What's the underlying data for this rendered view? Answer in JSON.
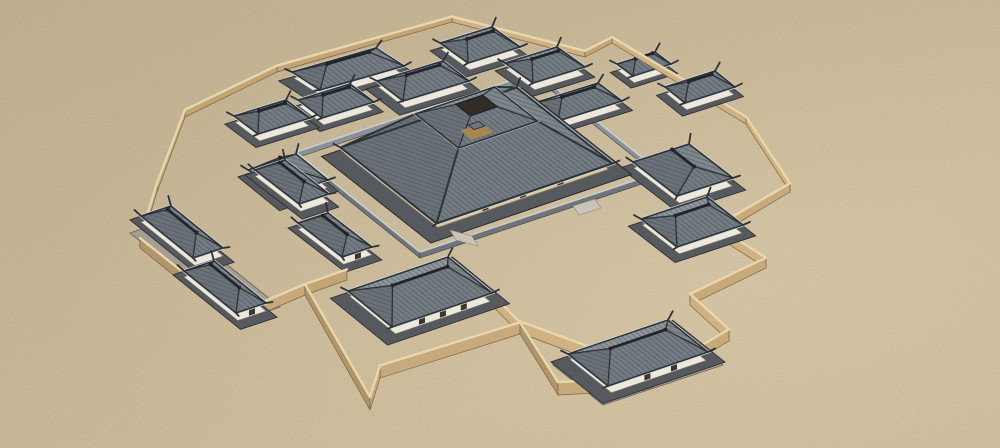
{
  "scene": {
    "viewBox": "0 0 1000 448",
    "width": 1000,
    "height": 448,
    "description": "3d-model-render-of-walled-temple-complex",
    "background": "#c9b692"
  },
  "palette": {
    "ground": "#c9b692",
    "wallLit": "#cfb183",
    "wallMid": "#c3a475",
    "wallDark": "#b2946b",
    "wallBack": "#c7a97c",
    "wallTop": "#e8d7ac",
    "wallEdge": "#7d6646",
    "roofS": "#747c83",
    "roofN": "#8e969c",
    "roofW": "#6a7178",
    "roofE": "#7f878d",
    "roofStripe": "#42484e",
    "roofEdge": "#2d3236",
    "ridge": "#21252a",
    "fascia": "#d5d8db",
    "platform": "#56595d",
    "platEdge": "#26292c",
    "white": "#ece8dc",
    "whiteEdge": "#6f6c64",
    "door": "#3a362d",
    "tanBand": "#d8c9a4",
    "step": "#cac4b8",
    "court": "#a59f93",
    "courtEdge": "#6e6960",
    "innerWallLit": "#8a9095",
    "innerWallDark": "#70757a",
    "innerWallTop": "#c9ced2",
    "openDark": "#322e27",
    "openFloor": "#a8874f",
    "openRoof": "#70757b"
  },
  "outerWall": {
    "heightBase": 5,
    "heightSlope": 0.02,
    "heightMax": 13,
    "points": [
      [
        157,
        192
      ],
      [
        185,
        117
      ],
      [
        277,
        72
      ],
      [
        452,
        22
      ],
      [
        585,
        57
      ],
      [
        612,
        43
      ],
      [
        746,
        124
      ],
      [
        790,
        192
      ],
      [
        716,
        236
      ],
      [
        766,
        268
      ],
      [
        690,
        305
      ],
      [
        729,
        341
      ],
      [
        648,
        390
      ],
      [
        558,
        395
      ],
      [
        520,
        334
      ],
      [
        380,
        378
      ],
      [
        370,
        410
      ],
      [
        305,
        295
      ],
      [
        235,
        325
      ],
      [
        140,
        248
      ]
    ],
    "stubs": [
      [
        [
          477,
          290
        ],
        [
          520,
          334
        ]
      ],
      [
        [
          520,
          333
        ],
        [
          603,
          364
        ]
      ],
      [
        [
          215,
          292
        ],
        [
          240,
          328
        ]
      ],
      [
        [
          305,
          295
        ],
        [
          347,
          280
        ]
      ]
    ]
  },
  "innerWall": {
    "w": [
      296,
      158
    ],
    "n": [
      536,
      78
    ],
    "e": [
      660,
      178
    ],
    "s": [
      420,
      258
    ],
    "height": 6
  },
  "courts": [
    {
      "name": "west-court-platform",
      "c": [
        205,
        262
      ],
      "u": [
        20,
        -7
      ],
      "v": [
        55,
        44
      ],
      "z": 253
    },
    {
      "name": "southeast-court-platform",
      "c": [
        638,
        357
      ],
      "u": [
        60,
        -20
      ],
      "v": [
        25,
        20
      ],
      "z": 317
    }
  ],
  "centralHall": {
    "name": "central-hall",
    "c": [
      476.5,
      155.5
    ],
    "u": [
      88,
      -30
    ],
    "v": [
      48,
      38
    ],
    "clerK": 0.45,
    "clerRaise": 38,
    "rimK": 0.15,
    "rimRaise": 50,
    "openK": 0.12,
    "openRaise": 24,
    "doors": 3,
    "z": 246,
    "steps": [
      [
        [
          450,
          230
        ],
        [
          472,
          236
        ],
        [
          478,
          246
        ],
        [
          456,
          240
        ]
      ],
      [
        [
          573,
          206
        ],
        [
          595,
          199
        ],
        [
          601,
          208
        ],
        [
          579,
          215
        ]
      ]
    ]
  },
  "buildings": [
    {
      "name": "north-court-west-hall",
      "c": [
        348,
        72
      ],
      "u": [
        42,
        -12
      ],
      "v": [
        14,
        9
      ],
      "axis": "u",
      "k": 0.5,
      "rh": 11
    },
    {
      "name": "north-court-east-hall-a",
      "c": [
        480,
        48
      ],
      "u": [
        26,
        -8
      ],
      "v": [
        14,
        10
      ],
      "axis": "u",
      "k": 0.5,
      "rh": 10
    },
    {
      "name": "north-court-east-hall-b",
      "c": [
        545,
        68
      ],
      "u": [
        26,
        -8
      ],
      "v": [
        14,
        10
      ],
      "axis": "u",
      "k": 0.5,
      "rh": 10
    },
    {
      "name": "northeast-pavilion-a",
      "c": [
        644,
        67
      ],
      "u": [
        19,
        -6
      ],
      "v": [
        8,
        6
      ],
      "axis": "u",
      "k": 0.45,
      "rh": 8
    },
    {
      "name": "northeast-pavilion-b",
      "c": [
        700,
        90
      ],
      "u": [
        25,
        -8
      ],
      "v": [
        10,
        8
      ],
      "axis": "u",
      "k": 0.45,
      "rh": 9
    },
    {
      "name": "inner-northeast-hall",
      "c": [
        578,
        105
      ],
      "u": [
        32,
        -10
      ],
      "v": [
        12,
        9
      ],
      "axis": "u",
      "k": 0.5,
      "rh": 10
    },
    {
      "name": "east-gatehouse",
      "c": [
        683,
        173
      ],
      "u": [
        28,
        -9
      ],
      "v": [
        22,
        17
      ],
      "axis": "v",
      "k": 0.5,
      "rh": 12
    },
    {
      "name": "southeast-pavilion",
      "c": [
        692,
        225
      ],
      "u": [
        33,
        -11
      ],
      "v": [
        18,
        14
      ],
      "axis": "u",
      "k": 0.5,
      "rh": 12
    },
    {
      "name": "southeast-court-hall",
      "c": [
        638,
        356
      ],
      "u": [
        50,
        -17
      ],
      "v": [
        20,
        16
      ],
      "axis": "u",
      "k": 0.55,
      "rh": 14,
      "doors": 2
    },
    {
      "name": "south-gatehouse",
      "c": [
        420,
        295
      ],
      "u": [
        50,
        -17
      ],
      "v": [
        22,
        18
      ],
      "axis": "u",
      "k": 0.55,
      "rh": 16,
      "doors": 3
    },
    {
      "name": "west-gatehouse",
      "c": [
        288,
        178
      ],
      "u": [
        24,
        -8
      ],
      "v": [
        16,
        13
      ],
      "axis": "v",
      "k": 0.5,
      "rh": 11
    },
    {
      "name": "northwest-pavilion",
      "c": [
        272,
        120
      ],
      "u": [
        26,
        -8
      ],
      "v": [
        12,
        9
      ],
      "axis": "u",
      "k": 0.5,
      "rh": 10
    },
    {
      "name": "inner-north-gatehouse",
      "c": [
        423,
        84
      ],
      "u": [
        33,
        -10
      ],
      "v": [
        13,
        10
      ],
      "axis": "u",
      "k": 0.5,
      "rh": 11
    },
    {
      "name": "inner-northwest-hall",
      "c": [
        336,
        104
      ],
      "u": [
        26,
        -8
      ],
      "v": [
        12,
        9
      ],
      "axis": "u",
      "k": 0.5,
      "rh": 10
    },
    {
      "name": "west-court-hall-north",
      "c": [
        182,
        235
      ],
      "u": [
        15,
        -5
      ],
      "v": [
        26,
        21
      ],
      "axis": "v",
      "k": 0.55,
      "rh": 11
    },
    {
      "name": "west-court-hall-south",
      "c": [
        225,
        290
      ],
      "u": [
        15,
        -5
      ],
      "v": [
        26,
        21
      ],
      "axis": "v",
      "k": 0.55,
      "rh": 11,
      "doors": 1
    },
    {
      "name": "southwest-hall-north",
      "c": [
        292,
        185
      ],
      "u": [
        15,
        -5
      ],
      "v": [
        22,
        17
      ],
      "axis": "v",
      "k": 0.55,
      "rh": 10
    },
    {
      "name": "southwest-hall-south",
      "c": [
        335,
        238
      ],
      "u": [
        15,
        -5
      ],
      "v": [
        22,
        17
      ],
      "axis": "v",
      "k": 0.55,
      "rh": 10,
      "doors": 1
    }
  ]
}
